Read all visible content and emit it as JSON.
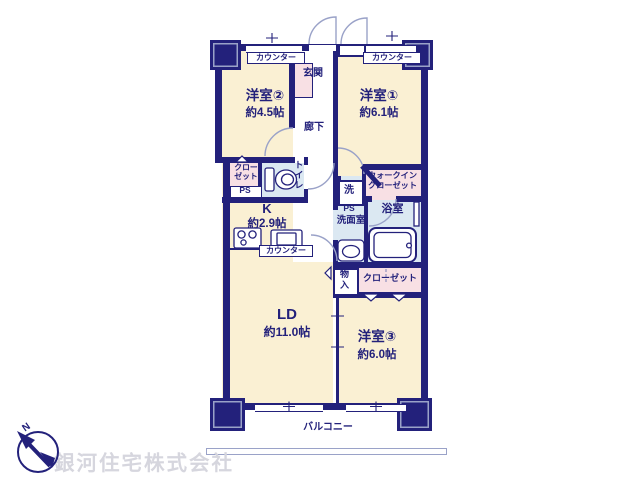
{
  "palette": {
    "wall": "#23217b",
    "room_cream": "#faf0d3",
    "closet_pink": "#f8e0e4",
    "wet_area_blue": "#dbe8f2",
    "door_arc_line": "#9aa2c8",
    "text": "#23217b",
    "watermark": "#d6d6de"
  },
  "labels": {
    "yoshitsu2_name": "洋室②",
    "yoshitsu2_size": "約4.5帖",
    "yoshitsu1_name": "洋室①",
    "yoshitsu1_size": "約6.1帖",
    "yoshitsu3_name": "洋室③",
    "yoshitsu3_size": "約6.0帖",
    "ld_name": "LD",
    "ld_size": "約11.0帖",
    "kitchen_name": "K",
    "kitchen_size": "約2.9帖",
    "genkan": "玄関",
    "rouka": "廊下",
    "toilet": "トイレ",
    "senmenshitsu": "洗面室",
    "yokushitsu": "浴室",
    "laundry": "洗",
    "walkin_closet_line1": "ウォークイン",
    "walkin_closet_line2": "クローゼット",
    "closet_nw_line1": "クロー",
    "closet_nw_line2": "ゼット",
    "closet_se": "クローゼット",
    "storage_line1": "物",
    "storage_line2": "入",
    "ps_nw": "PS",
    "ps_center": "PS",
    "counter_nw": "カウンター",
    "counter_ne": "カウンター",
    "counter_kitchen": "カウンター",
    "balcony": "バルコニー",
    "compass_n": "N",
    "company": "銀河住宅株式会社"
  }
}
